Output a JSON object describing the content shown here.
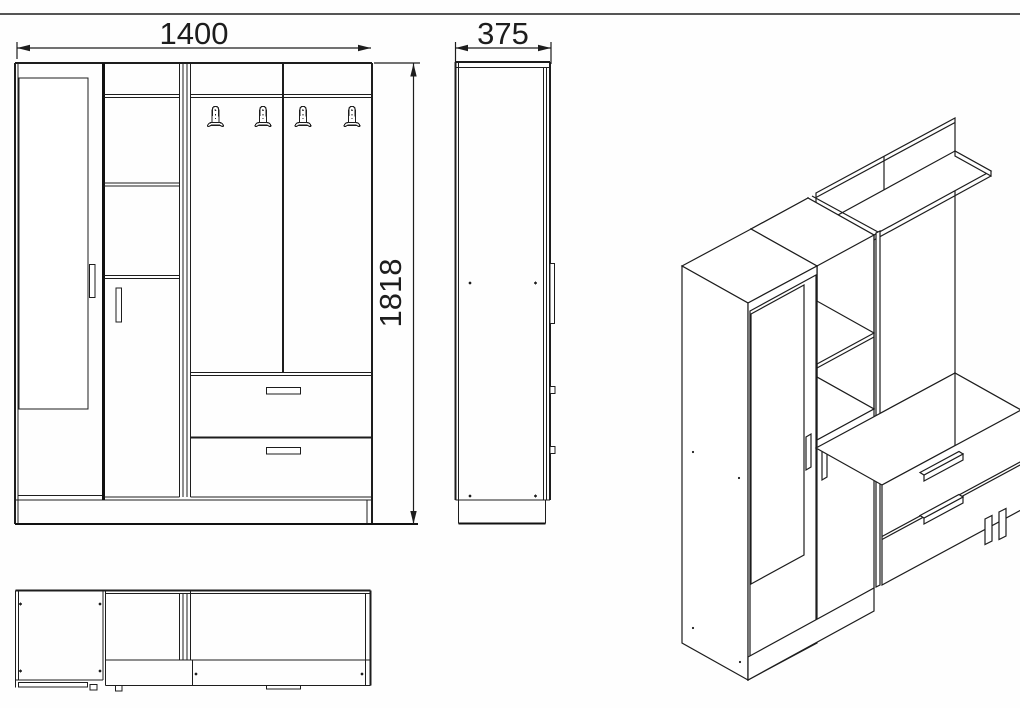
{
  "drawing": {
    "background": "#fefefe",
    "line_color": "#1d1d1d",
    "dimensions": {
      "width_mm": "1400",
      "depth_mm": "375",
      "height_mm": "1818"
    },
    "icons": {
      "coat_hook": "coat-hook-icon"
    }
  }
}
